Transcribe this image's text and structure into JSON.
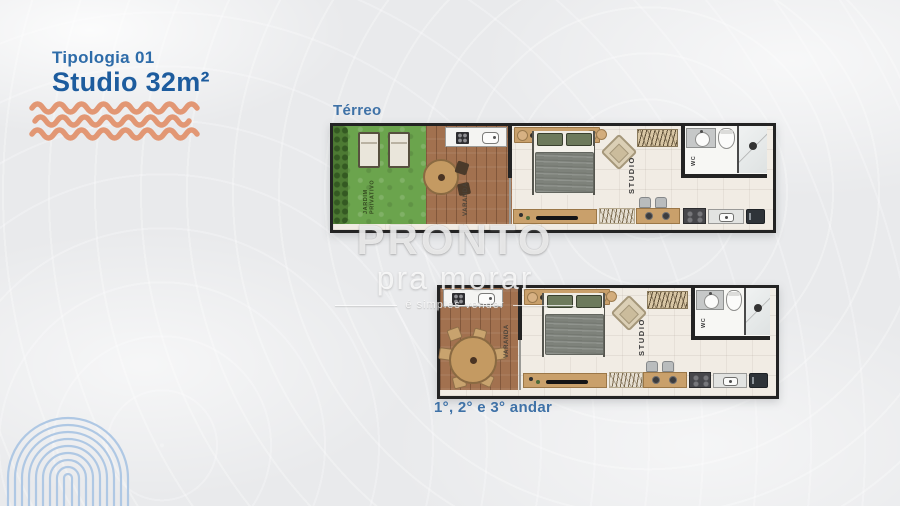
{
  "header": {
    "typology_label": "Tipologia 01",
    "title": "Studio 32m²"
  },
  "floor_plans": {
    "ground": {
      "label": "Térreo",
      "rooms": {
        "garden": "JARDIM PRIVATIVO",
        "balcony": "VARANDA",
        "studio": "STUDIO",
        "wc": "WC"
      }
    },
    "upper": {
      "label": "1°, 2° e 3° andar",
      "rooms": {
        "balcony": "VARANDA",
        "studio": "STUDIO",
        "wc": "WC"
      }
    }
  },
  "watermark": {
    "brand": "PRONTO",
    "brand_sub": "pra morar",
    "tagline": "é simples vender"
  },
  "colors": {
    "accent_blue": "#2e6ca9",
    "title_blue": "#1d5c9e",
    "accent_orange": "#e2906a",
    "fingerprint_blue": "#afc8e4",
    "garden_green": "#6ba44d",
    "deck_wood": "#a2714f",
    "wall_dark": "#232323"
  }
}
